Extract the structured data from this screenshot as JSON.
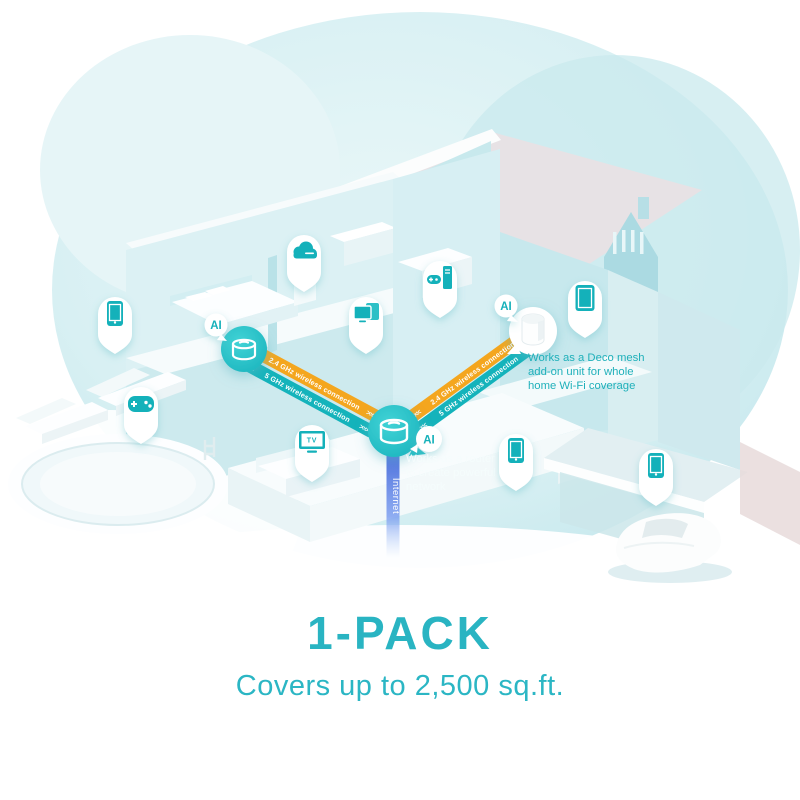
{
  "branding": {
    "title": "1-PACK",
    "subtitle": "Covers up to 2,500 sq.ft."
  },
  "network": {
    "ai_badge": "AI",
    "internet_label": "Internet",
    "chevrons_left": "<<<",
    "chevrons_right": ">>>",
    "links": {
      "left": {
        "band_24": "2.4 GHz wireless connection",
        "band_5": "5 GHz wireless connection"
      },
      "right": {
        "band_24": "2.4 GHz wireless connection",
        "band_5": "5 GHz wireless connection"
      }
    },
    "main_router_note": {
      "line1": "Works as a router",
      "line2": "to create powerful",
      "line3": "network"
    },
    "addon_note": {
      "line1": "Works as a Deco mesh",
      "line2": "add-on unit for whole",
      "line3": "home Wi-Fi coverage"
    }
  },
  "devices": {
    "tv_label": "TV",
    "pins": [
      "smartphone-icon",
      "game-controller-icon",
      "cloud-icon",
      "dual-screens-icon",
      "game-console-icon",
      "tv-icon",
      "tablet-icon",
      "smartphone-icon",
      "smartphone-icon"
    ]
  },
  "colors": {
    "teal_accent": "#14b1ba",
    "router_teal": "#27c2c7",
    "band_yellow": "#f4a61e",
    "band_teal": "#14b3bb",
    "internet_blue": "#4a66d8",
    "caption_teal": "#29b4c2",
    "blob_tint": "#d4eef1"
  }
}
